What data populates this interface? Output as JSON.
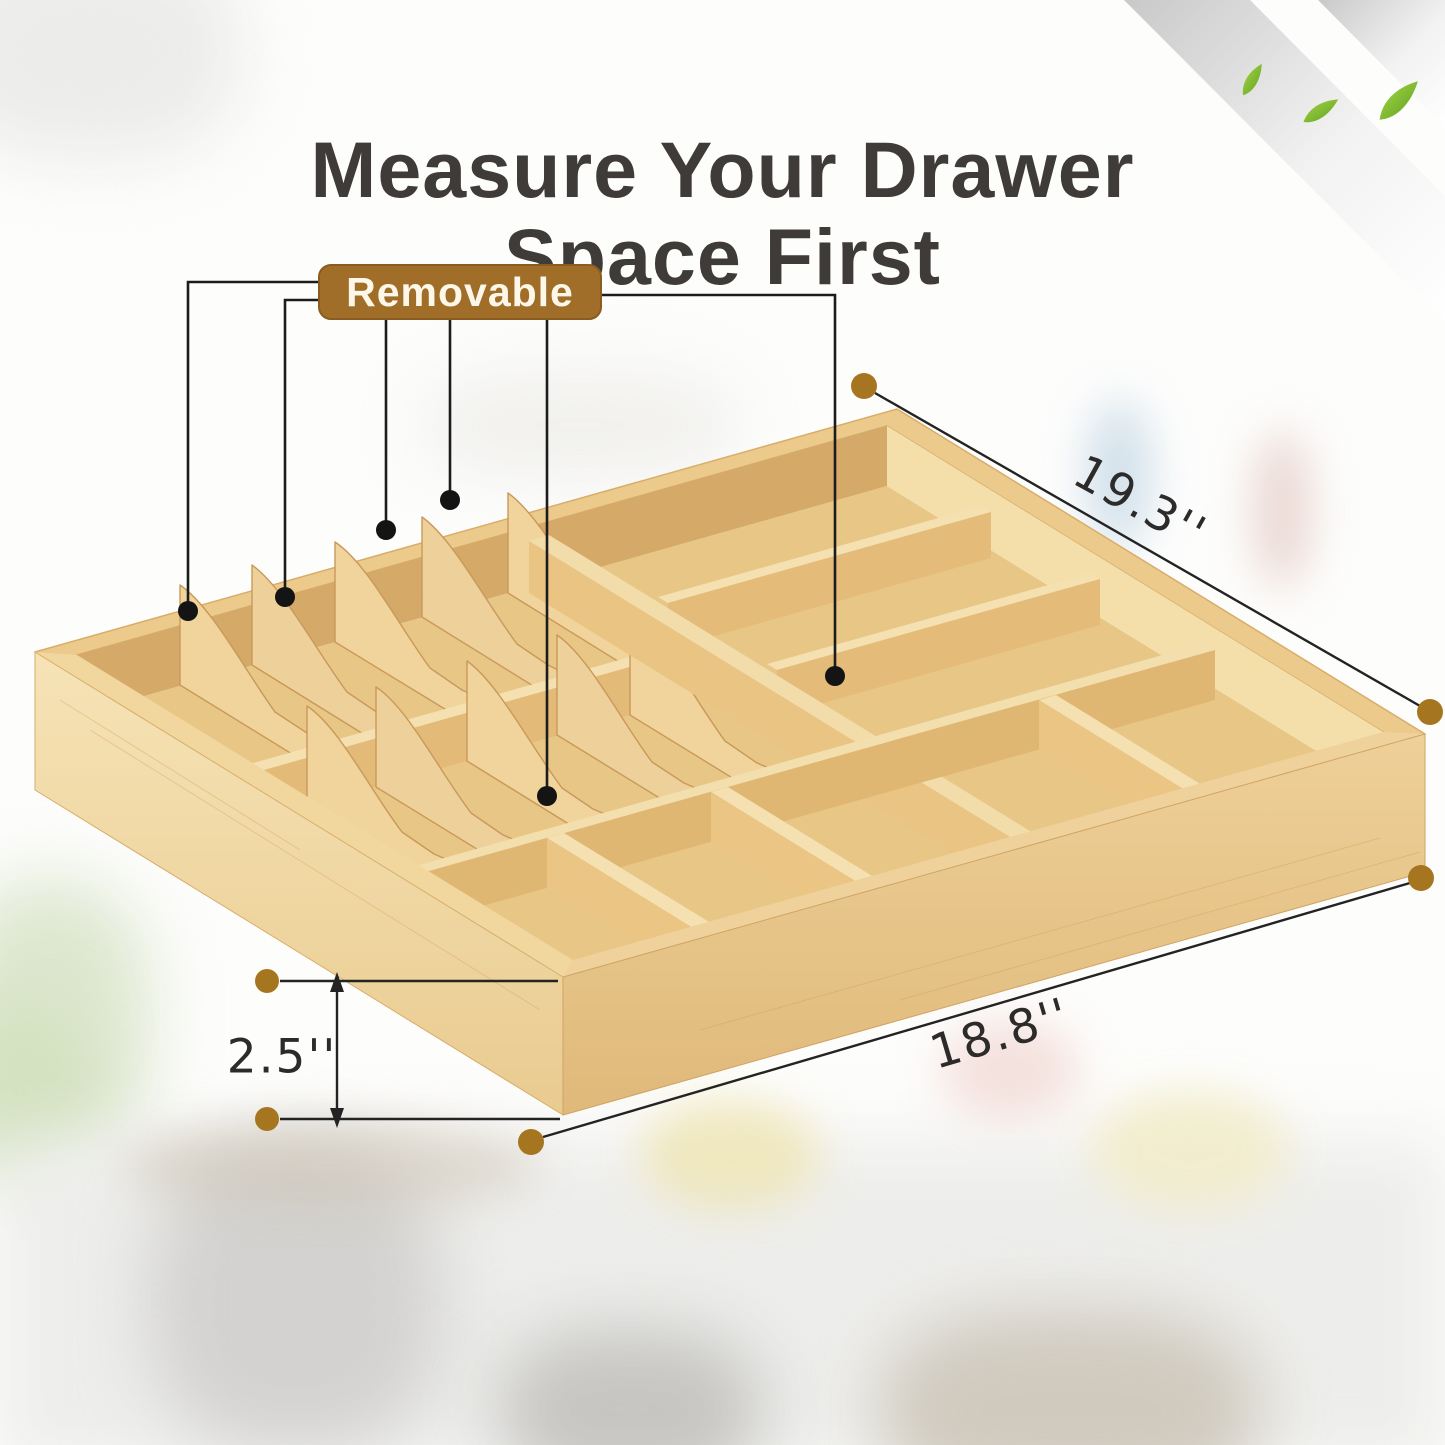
{
  "title": {
    "line1": "Measure Your Drawer",
    "line2": "Space First"
  },
  "callout": {
    "label": "Removable"
  },
  "measurements": {
    "top_width": "19.3''",
    "bottom_width": "18.8''",
    "height": "2.5''"
  },
  "colors": {
    "title_text": "#3f3b38",
    "badge_background": "#a06e29",
    "badge_text": "#fdf7ea",
    "callout_line": "#1c1c1c",
    "dimension_dot": "#a5761f",
    "dimension_text": "#2d2b29",
    "bamboo_light": "#f4e0b2",
    "bamboo_mid": "#e9c98c",
    "bamboo_shadow": "#d6ab6b",
    "leaf_green": "#8cc63e",
    "ribbon_gray": "#d9d9d9"
  }
}
